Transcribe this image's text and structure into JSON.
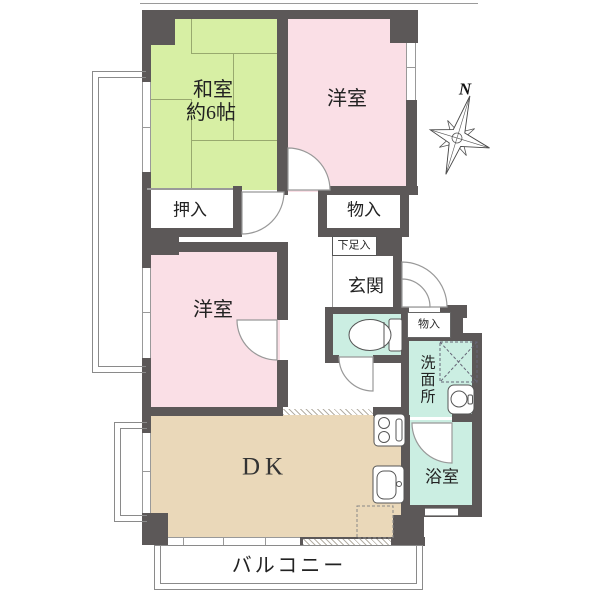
{
  "type": "apartment-floor-plan",
  "compass": {
    "label": "N"
  },
  "rooms": {
    "washitsu": {
      "label": "和室",
      "size": "約6帖"
    },
    "youshitsu_top": {
      "label": "洋室"
    },
    "youshitsu_mid": {
      "label": "洋室"
    },
    "oshiire": {
      "label": "押入"
    },
    "monoire_upper": {
      "label": "物入"
    },
    "getabako": {
      "label": "下足入"
    },
    "genkan": {
      "label": "玄関"
    },
    "monoire_side": {
      "label": "物入"
    },
    "senmenjo": {
      "label": "洗面所"
    },
    "yokushitsu": {
      "label": "浴室"
    },
    "dk": {
      "label": "DK"
    },
    "balcony": {
      "label": "バルコニー"
    }
  },
  "colors": {
    "wall": "#5c5858",
    "tatami_room": "#d7efa4",
    "western_room": "#fadfe6",
    "wet_area": "#cbeee2",
    "dining_kitchen": "#ead8b9",
    "background": "#ffffff"
  },
  "fixtures": [
    "toilet-icon",
    "washing-machine-icon",
    "washbasin-icon",
    "stove-icon",
    "kitchen-sink-icon",
    "refrigerator-space",
    "compass-rose-icon"
  ]
}
